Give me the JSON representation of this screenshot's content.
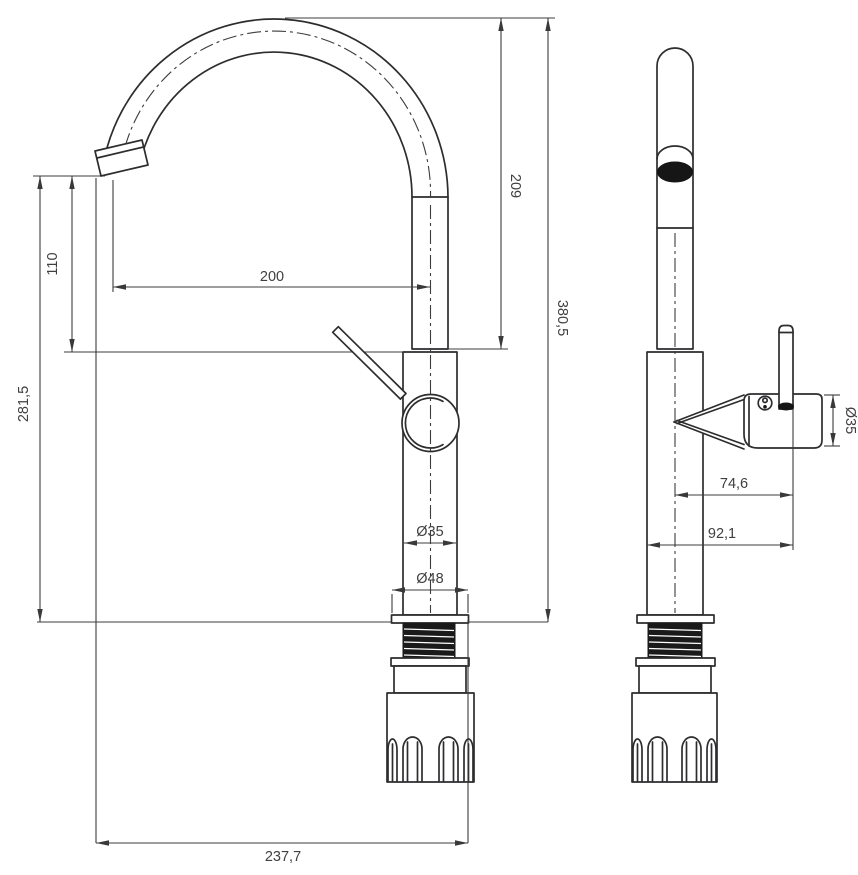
{
  "drawing": {
    "kind": "faucet technical dimension drawing",
    "units": "mm",
    "views": {
      "front_view_label": "front view (spout arc)",
      "side_view_label": "side view (handle)"
    },
    "dimensions": {
      "spout_height": "209",
      "overall_height": "380,5",
      "spout_drop": "110",
      "outlet_height": "281,5",
      "spout_reach": "200",
      "body_diameter": "Ø35",
      "base_diameter": "Ø48",
      "overall_depth": "237,7",
      "side_body_diameter": "Ø35",
      "handle_center_offset": "74,6",
      "handle_total_offset": "92,1"
    }
  }
}
